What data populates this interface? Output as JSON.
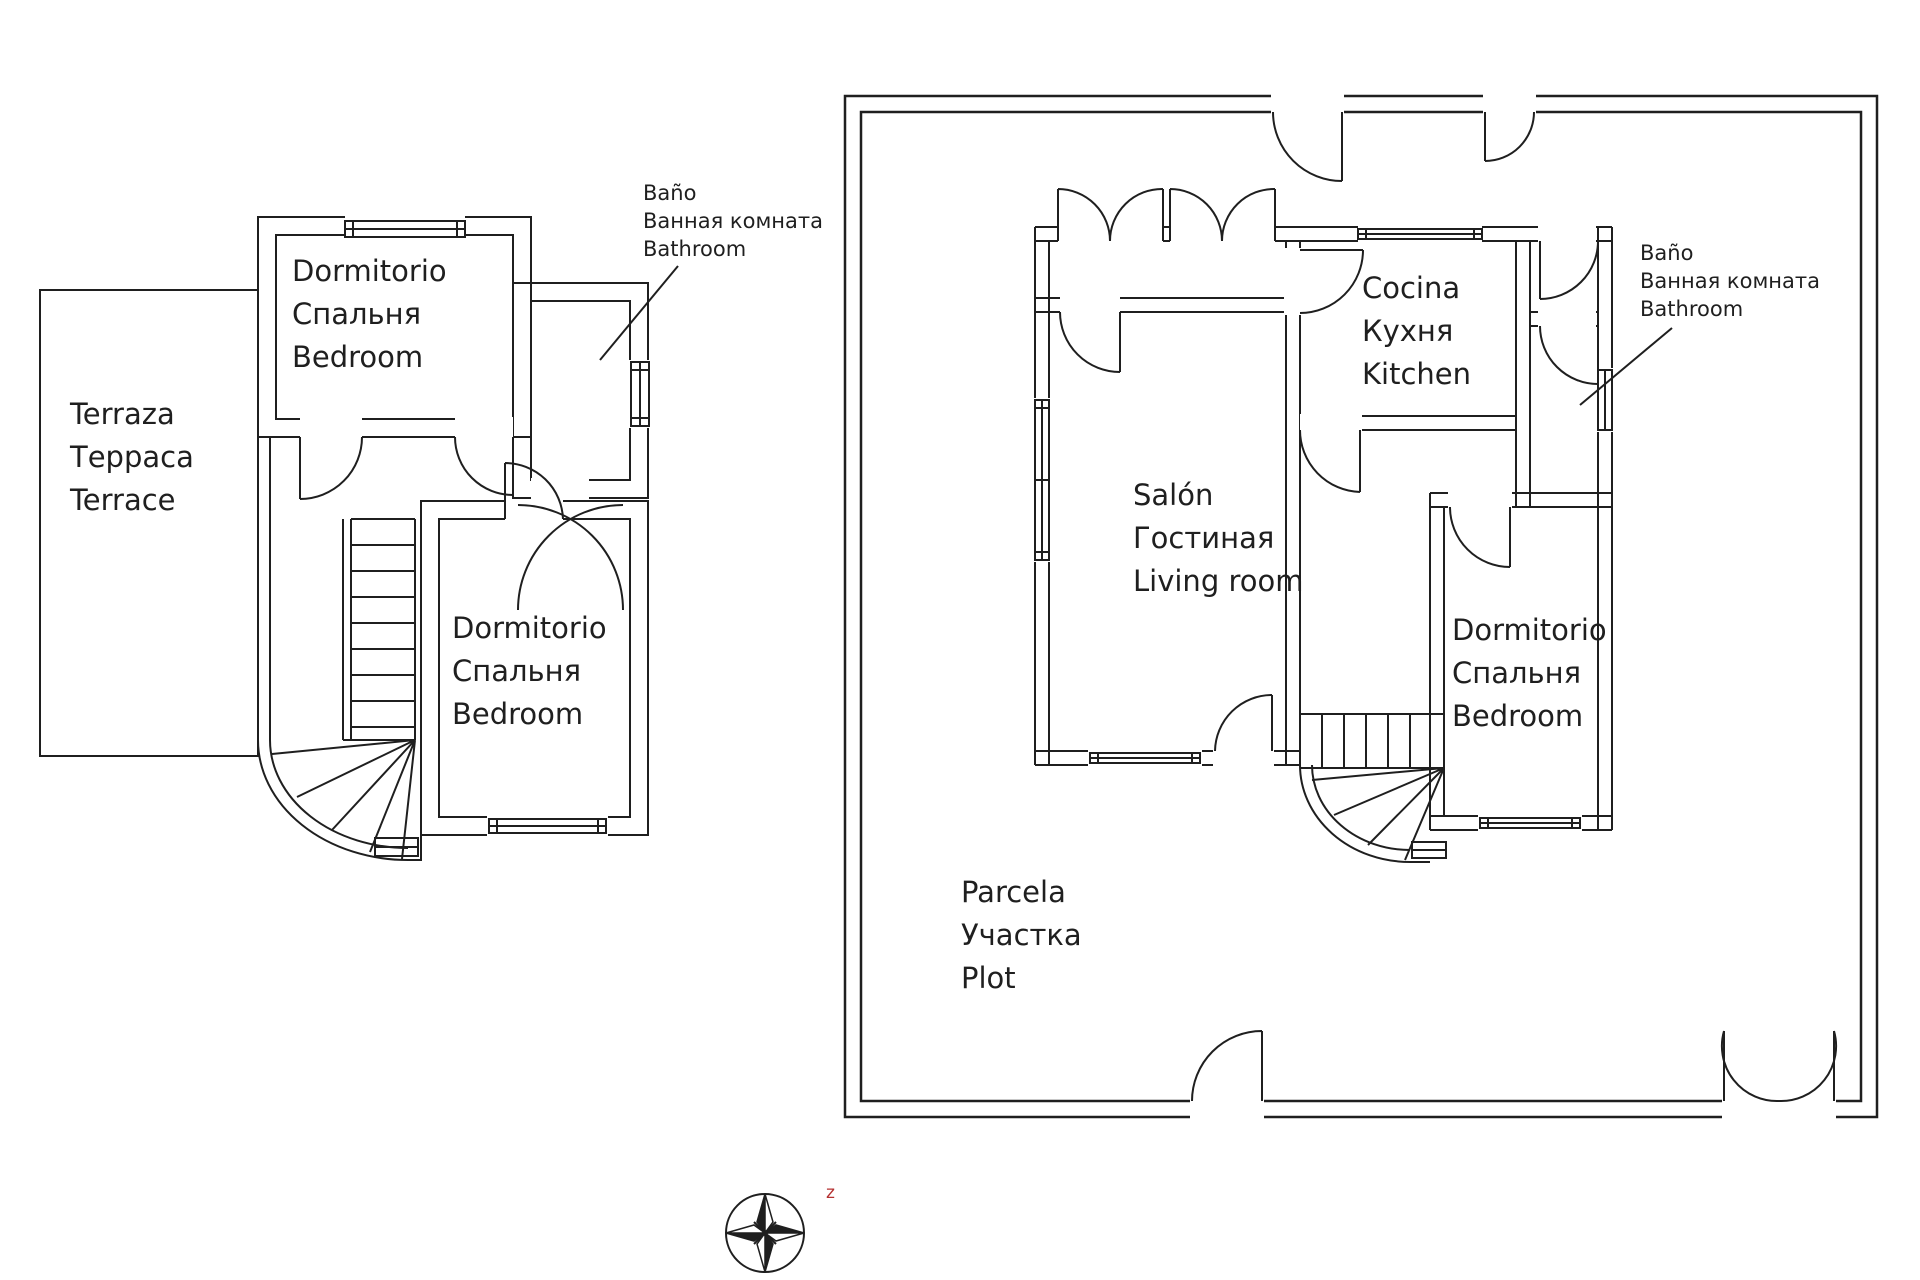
{
  "upper_floor": {
    "terrace": [
      "Terraza",
      "Терраса",
      "Terrace"
    ],
    "bedroom_top": [
      "Dormitorio",
      "Спальня",
      "Bedroom"
    ],
    "bedroom_bottom": [
      "Dormitorio",
      "Спальня",
      "Bedroom"
    ],
    "bathroom_note": [
      "Baño",
      "Ванная комната",
      "Bathroom"
    ]
  },
  "ground_floor": {
    "kitchen": [
      "Cocina",
      "Кухня",
      "Kitchen"
    ],
    "living_room": [
      "Salón",
      "Гостиная",
      "Living room"
    ],
    "bedroom": [
      "Dormitorio",
      "Спальня",
      "Bedroom"
    ],
    "bathroom_note": [
      "Baño",
      "Ванная комната",
      "Bathroom"
    ],
    "plot": [
      "Parcela",
      "Участка",
      "Plot"
    ]
  },
  "compass": {
    "marker": "z"
  },
  "colors": {
    "line": "#1f1f1f",
    "marker_red": "#b43030",
    "background": "#ffffff"
  }
}
